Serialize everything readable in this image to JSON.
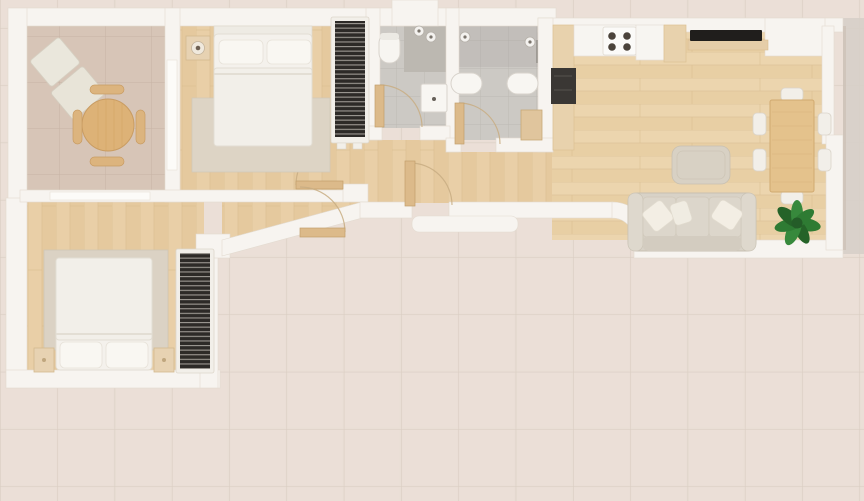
{
  "meta": {
    "title": "apartment-floor-plan-top-view",
    "type": "3d-rendered-floor-plan",
    "view": "top-down",
    "has_text": false
  },
  "colors": {
    "wall": "#f7f4f0",
    "terrace_tile": "#e9ded5",
    "terrace_grout": "#d9ccc1",
    "exterior_right": "#d6cfc8",
    "room_tile": "#d7c5b7",
    "room_grout": "#c7b3a4",
    "bath_tile": "#ccc9c4",
    "bath_grout": "#bdb9b3",
    "shower_tile": "#bcb8b1",
    "wood_floor": "#e9cfa7",
    "wood_stripe": "#ddc194",
    "door_wood": "#dcba8a",
    "door_arc": "#c8ad82",
    "wardrobe_dark": "#2d2a27",
    "bed_white": "#f4f1ec",
    "pillow_white": "#f9f7f2",
    "rug": "#ddd4c5",
    "sofa_body": "#d8d2c7",
    "sofa_cushion": "#dcd6cb",
    "throw_pillow": "#f3eee4",
    "table_wood": "#ddb277",
    "dining_table_wood": "#e4c28c",
    "chair_white": "#f2efe9",
    "plant_green": "#2e7b33",
    "plant_green_dark": "#245c28",
    "tv_black": "#201e1c",
    "appliance_dark": "#3a3734",
    "burner_dark": "#4b433b",
    "counter_white": "#f7f5f1",
    "cabinet_wood": "#e8d2ad"
  },
  "rooms": [
    {
      "id": "sitting-room",
      "floor": "large beige ceramic tile",
      "furniture": [
        "lounge-chair",
        "lounge-chair",
        "round-wood-table",
        "stool",
        "stool",
        "stool",
        "stool"
      ]
    },
    {
      "id": "bedroom-1",
      "floor": "light wood plank",
      "furniture": [
        "double-bed",
        "nightstand-with-lamp",
        "area-rug",
        "slatted-wardrobe"
      ]
    },
    {
      "id": "bedroom-2",
      "floor": "light wood plank",
      "furniture": [
        "double-bed",
        "nightstand",
        "nightstand",
        "area-rug",
        "slatted-wardrobe"
      ]
    },
    {
      "id": "bathroom-1",
      "floor": "grey tile",
      "furniture": [
        "toilet",
        "shower-area",
        "ceiling-light",
        "ceiling-light",
        "washbasin"
      ]
    },
    {
      "id": "bathroom-2",
      "floor": "grey tile",
      "furniture": [
        "toilet",
        "bidet",
        "ceiling-light",
        "ceiling-light",
        "wood-cabinet"
      ]
    },
    {
      "id": "hallway",
      "floor": "light wood plank",
      "furniture": []
    },
    {
      "id": "kitchen",
      "floor": "light wood plank",
      "furniture": [
        "tall-unit",
        "dark-appliance",
        "countertop",
        "cooktop-4-burners",
        "wood-counter"
      ]
    },
    {
      "id": "living-dining-room",
      "floor": "light wood plank",
      "furniture": [
        "wall-tv",
        "media-shelf",
        "coffee-table",
        "dining-table",
        "chair",
        "chair",
        "chair",
        "chair",
        "chair",
        "chair",
        "sofa-3-seat",
        "throw-pillow",
        "throw-pillow",
        "throw-pillow",
        "potted-plant"
      ]
    },
    {
      "id": "terrace",
      "floor": "large beige stone tile",
      "furniture": []
    }
  ],
  "doors": [
    {
      "id": "bedroom-1-door",
      "type": "hinged",
      "state": "open"
    },
    {
      "id": "bedroom-2-door",
      "type": "hinged",
      "state": "open"
    },
    {
      "id": "bathroom-1-door",
      "type": "hinged",
      "state": "open"
    },
    {
      "id": "bathroom-2-door",
      "type": "hinged",
      "state": "open"
    },
    {
      "id": "entrance-door",
      "type": "hinged",
      "state": "open"
    },
    {
      "id": "sitting-room-sliding-door",
      "type": "sliding",
      "state": "closed"
    },
    {
      "id": "partition-sliding-door",
      "type": "sliding",
      "state": "closed"
    }
  ]
}
